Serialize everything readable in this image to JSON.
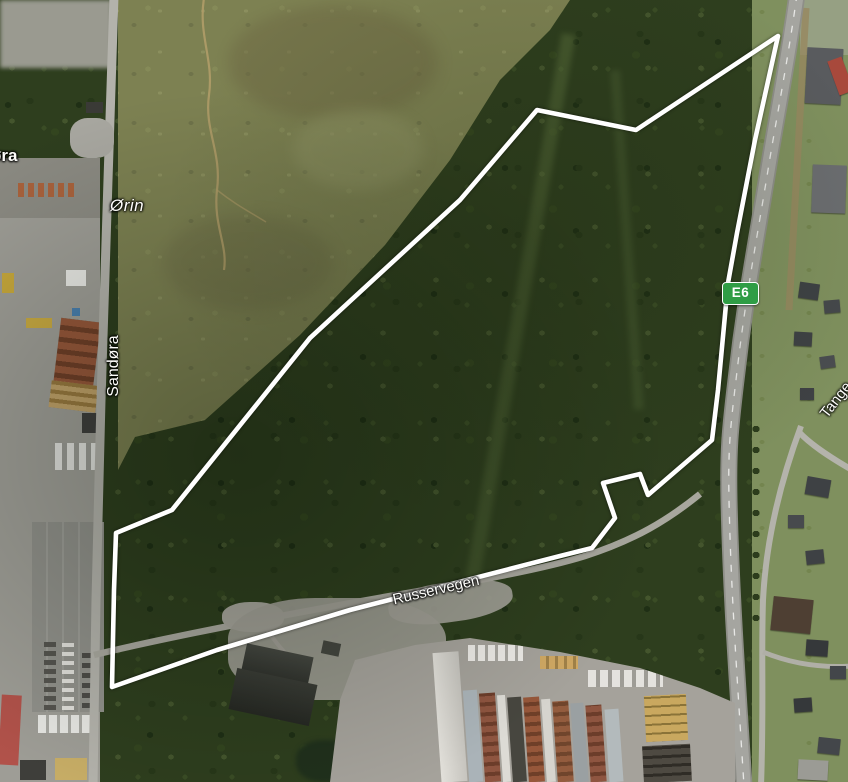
{
  "map": {
    "labels": {
      "place_partial_left": "øra",
      "place_orin": "Ørin",
      "road_sandora": "Sandøra",
      "road_russervegen": "Russervegen",
      "road_tangen_partial": "Tange",
      "route_badge": "E6"
    },
    "colors": {
      "route_badge_bg": "#2f9d45",
      "route_badge_border": "#ffffff",
      "boundary_stroke": "#ffffff",
      "forest": "#2e3e1e",
      "marsh_field": "#7d8152",
      "highway": "#a5a5a0",
      "industrial_ground": "#9e9d96"
    },
    "overlay": {
      "boundary_points": "778,36 755,140 737,233 728,283 718,390 712,440 648,495 640,474 603,483 615,518 592,548 560,556 350,610 217,650 112,687 114,590 116,533 172,510 310,338 460,200 537,110 636,130"
    }
  }
}
